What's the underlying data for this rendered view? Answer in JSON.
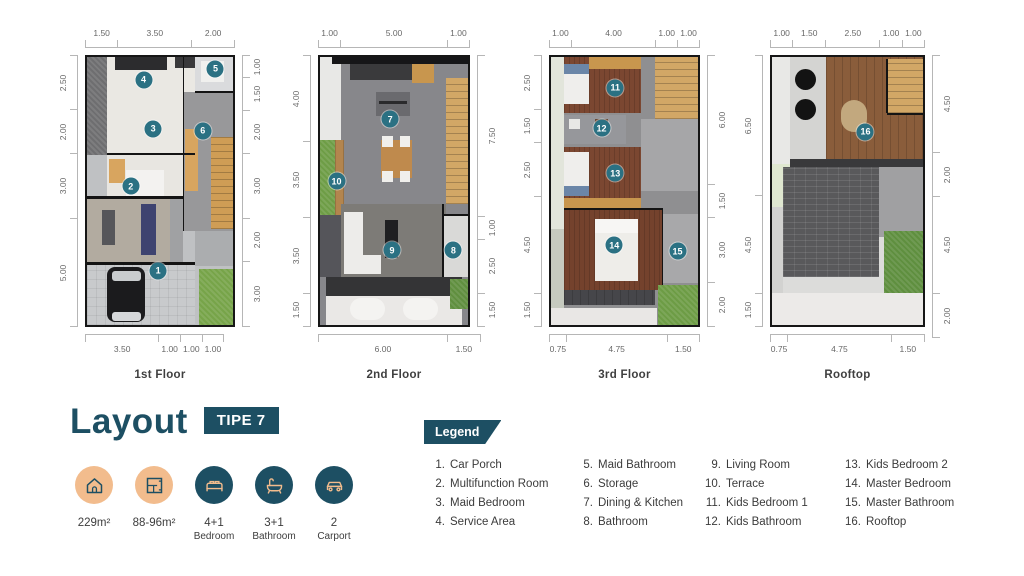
{
  "palette": {
    "teal": "#1d4f63",
    "peach": "#f2bc8d",
    "marker": "#2b7183"
  },
  "title": {
    "text": "Layout",
    "badge": "TIPE 7"
  },
  "stats": [
    {
      "icon": "house-icon",
      "style": "peach",
      "value": "229m²",
      "label": ""
    },
    {
      "icon": "floorplan-icon",
      "style": "peach",
      "value": "88-96m²",
      "label": ""
    },
    {
      "icon": "bed-icon",
      "style": "teal",
      "value": "4+1",
      "label": "Bedroom"
    },
    {
      "icon": "bathtub-icon",
      "style": "teal",
      "value": "3+1",
      "label": "Bathroom"
    },
    {
      "icon": "car-icon",
      "style": "teal",
      "value": "2",
      "label": "Carport"
    }
  ],
  "legend": {
    "title": "Legend",
    "columns": [
      [
        {
          "num": "1.",
          "label": "Car Porch"
        },
        {
          "num": "2.",
          "label": "Multifunction Room"
        },
        {
          "num": "3.",
          "label": "Maid Bedroom"
        },
        {
          "num": "4.",
          "label": "Service Area"
        }
      ],
      [
        {
          "num": "5.",
          "label": "Maid Bathroom"
        },
        {
          "num": "6.",
          "label": "Storage"
        },
        {
          "num": "7.",
          "label": "Dining & Kitchen"
        },
        {
          "num": "8.",
          "label": "Bathroom"
        }
      ],
      [
        {
          "num": "9.",
          "label": "Living Room"
        },
        {
          "num": "10.",
          "label": "Terrace"
        },
        {
          "num": "11.",
          "label": "Kids Bedroom 1"
        },
        {
          "num": "12.",
          "label": "Kids Bathroom"
        }
      ],
      [
        {
          "num": "13.",
          "label": "Kids Bedroom 2"
        },
        {
          "num": "14.",
          "label": "Master Bedroom"
        },
        {
          "num": "15.",
          "label": "Master Bathroom"
        },
        {
          "num": "16.",
          "label": "Rooftop"
        }
      ]
    ]
  },
  "floors": [
    {
      "name": "1st Floor",
      "dims": {
        "top": [
          "1.50",
          "3.50",
          "2.00"
        ],
        "bottom": [
          "3.50",
          "1.00",
          "1.00",
          "1.00"
        ],
        "left": [
          "2.50",
          "2.00",
          "3.00",
          "5.00"
        ],
        "right": [
          "1.00",
          "1.50",
          "2.00",
          "3.00",
          "2.00",
          "3.00"
        ]
      },
      "markers": [
        {
          "n": "1",
          "x": 48.7,
          "y": 79.8
        },
        {
          "n": "2",
          "x": 30.0,
          "y": 48.2
        },
        {
          "n": "3",
          "x": 45.3,
          "y": 26.8
        },
        {
          "n": "4",
          "x": 38.7,
          "y": 8.5
        },
        {
          "n": "5",
          "x": 88.0,
          "y": 4.4
        },
        {
          "n": "6",
          "x": 79.3,
          "y": 27.6
        }
      ]
    },
    {
      "name": "2nd Floor",
      "dims": {
        "top": [
          "1.00",
          "5.00",
          "1.00"
        ],
        "bottom": [
          "6.00",
          "1.50"
        ],
        "left": [
          "4.00",
          "3.50",
          "3.50",
          "1.50"
        ],
        "right": [
          "7.50",
          "1.00",
          "2.50",
          "1.50"
        ]
      },
      "markers": [
        {
          "n": "7",
          "x": 47.4,
          "y": 23.2
        },
        {
          "n": "8",
          "x": 90.1,
          "y": 72.1
        },
        {
          "n": "9",
          "x": 48.7,
          "y": 72.1
        },
        {
          "n": "10",
          "x": 11.2,
          "y": 46.3
        }
      ]
    },
    {
      "name": "3rd Floor",
      "dims": {
        "top": [
          "1.00",
          "4.00",
          "1.00",
          "1.00"
        ],
        "bottom": [
          "0.75",
          "4.75",
          "1.50"
        ],
        "left": [
          "2.50",
          "1.50",
          "2.50",
          "4.50",
          "1.50"
        ],
        "right": [
          "6.00",
          "1.50",
          "3.00",
          "2.00"
        ]
      },
      "markers": [
        {
          "n": "11",
          "x": 43.7,
          "y": 11.4
        },
        {
          "n": "12",
          "x": 34.4,
          "y": 26.5
        },
        {
          "n": "13",
          "x": 43.7,
          "y": 43.4
        },
        {
          "n": "14",
          "x": 43.0,
          "y": 70.2
        },
        {
          "n": "15",
          "x": 86.1,
          "y": 72.4
        }
      ]
    },
    {
      "name": "Rooftop",
      "dims": {
        "top": [
          "1.00",
          "1.50",
          "2.50",
          "1.00",
          "1.00"
        ],
        "bottom": [
          "0.75",
          "4.75",
          "1.50"
        ],
        "left": [
          "6.50",
          "4.50",
          "1.50"
        ],
        "right": [
          "4.50",
          "2.00",
          "4.50",
          "2.00"
        ]
      },
      "markers": [
        {
          "n": "16",
          "x": 61.9,
          "y": 27.9
        }
      ]
    }
  ]
}
